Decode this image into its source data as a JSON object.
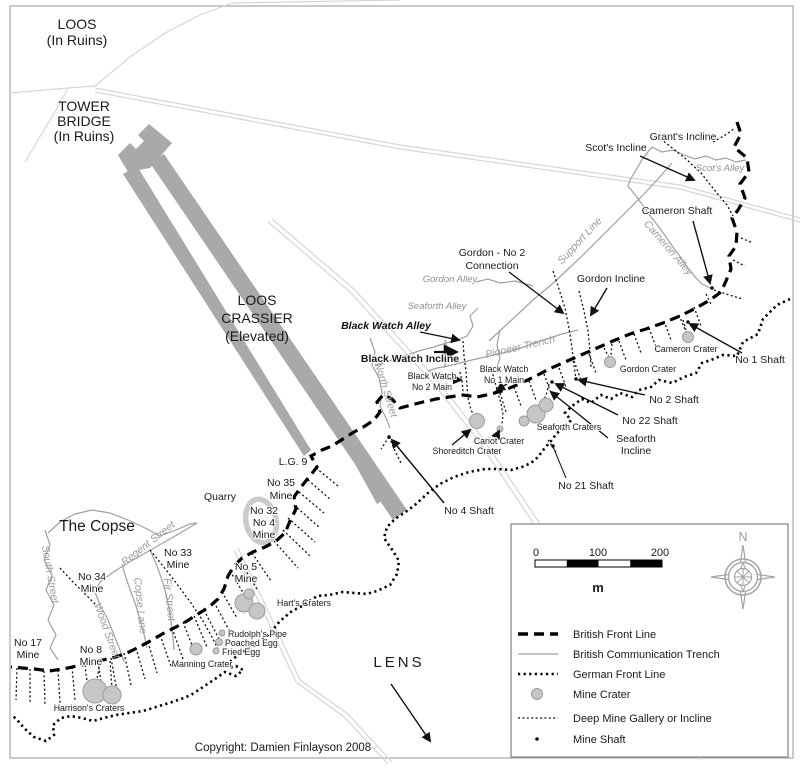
{
  "map": {
    "copyright": "Copyright: Damien Finlayson 2008",
    "colors": {
      "british_front_line": "#000000",
      "communication_trench": "#a0a0a0",
      "german_front_line": "#000000",
      "mine_gallery": "#000000",
      "crater_fill": "#c6c6c6",
      "crater_stroke": "#9c9c9c",
      "crassier_fill": "#a9a9a9",
      "road": "#d6d6d6",
      "frame": "#adadad"
    },
    "labels": [
      {
        "id": "loos",
        "lines": [
          "LOOS",
          "(In Ruins)"
        ],
        "x": 77,
        "y": 29,
        "lh": 16,
        "cls": "big"
      },
      {
        "id": "tower-bridge",
        "lines": [
          "TOWER",
          "BRIDGE",
          "(In Ruins)"
        ],
        "x": 84,
        "y": 111,
        "lh": 15,
        "cls": "big"
      },
      {
        "id": "loos-crassier",
        "lines": [
          "LOOS",
          "CRASSIER",
          "(Elevated)"
        ],
        "x": 257,
        "y": 305,
        "lh": 18,
        "cls": "big"
      },
      {
        "id": "the-copse",
        "lines": [
          "The Copse"
        ],
        "x": 97,
        "y": 531,
        "cls": "big2"
      },
      {
        "id": "lens",
        "lines": [
          "LENS"
        ],
        "x": 399,
        "y": 667,
        "cls": "lens"
      },
      {
        "id": "grants-incline",
        "lines": [
          "Grant's Incline"
        ],
        "x": 683,
        "y": 140,
        "cls": "lab"
      },
      {
        "id": "scots-incline",
        "lines": [
          "Scot's Incline"
        ],
        "x": 616,
        "y": 151,
        "cls": "lab"
      },
      {
        "id": "scots-alley",
        "lines": [
          "Scot's Alley"
        ],
        "x": 720,
        "y": 171,
        "cls": "ital"
      },
      {
        "id": "cameron-shaft",
        "lines": [
          "Cameron Shaft"
        ],
        "x": 677,
        "y": 214,
        "cls": "lab"
      },
      {
        "id": "support-line",
        "lines": [
          "Support Line"
        ],
        "x": 582,
        "y": 243,
        "rotate": -47,
        "cls": "ital2"
      },
      {
        "id": "cameron-alley",
        "lines": [
          "Cameron Alley"
        ],
        "x": 666,
        "y": 250,
        "rotate": 49,
        "cls": "ital2"
      },
      {
        "id": "gordon-no2-connection",
        "lines": [
          "Gordon - No 2",
          "Connection"
        ],
        "x": 492,
        "y": 256,
        "lh": 13,
        "cls": "lab"
      },
      {
        "id": "gordon-incline",
        "lines": [
          "Gordon Incline"
        ],
        "x": 611,
        "y": 282,
        "cls": "lab"
      },
      {
        "id": "gordon-alley",
        "lines": [
          "Gordon Alley"
        ],
        "x": 450,
        "y": 282,
        "cls": "ital"
      },
      {
        "id": "seaforth-alley",
        "lines": [
          "Seaforth Alley"
        ],
        "x": 437,
        "y": 309,
        "cls": "ital"
      },
      {
        "id": "black-watch-alley",
        "lines": [
          "Black Watch Alley"
        ],
        "x": 386,
        "y": 329,
        "cls": "boldital"
      },
      {
        "id": "pioneer-trench",
        "lines": [
          "Pioneer Trench"
        ],
        "x": 521,
        "y": 350,
        "rotate": -13,
        "cls": "ital2"
      },
      {
        "id": "black-watch-incline",
        "lines": [
          "Black Watch Incline"
        ],
        "x": 410,
        "y": 362,
        "cls": "boldlab"
      },
      {
        "id": "north-street",
        "lines": [
          "North Street"
        ],
        "x": 383,
        "y": 391,
        "rotate": 73,
        "cls": "ital2"
      },
      {
        "id": "black-watch-no2-main",
        "lines": [
          "Black Watch",
          "No 2 Main"
        ],
        "x": 432,
        "y": 379,
        "lh": 11,
        "cls": "small"
      },
      {
        "id": "black-watch-no1-main",
        "lines": [
          "Black Watch",
          "No 1 Main"
        ],
        "x": 504,
        "y": 372,
        "lh": 11,
        "cls": "small"
      },
      {
        "id": "cameron-crater",
        "lines": [
          "Cameron Crater"
        ],
        "x": 686,
        "y": 352,
        "cls": "small"
      },
      {
        "id": "no1-shaft",
        "lines": [
          "No 1 Shaft"
        ],
        "x": 760,
        "y": 363,
        "cls": "lab"
      },
      {
        "id": "gordon-crater",
        "lines": [
          "Gordon Crater"
        ],
        "x": 648,
        "y": 372,
        "cls": "small"
      },
      {
        "id": "no2-shaft",
        "lines": [
          "No 2 Shaft"
        ],
        "x": 674,
        "y": 403,
        "cls": "lab"
      },
      {
        "id": "no22-shaft",
        "lines": [
          "No 22 Shaft"
        ],
        "x": 650,
        "y": 424,
        "cls": "lab"
      },
      {
        "id": "seaforth-craters",
        "lines": [
          "Seaforth Craters"
        ],
        "x": 569,
        "y": 430,
        "cls": "small"
      },
      {
        "id": "seaforth-incline",
        "lines": [
          "Seaforth",
          "Incline"
        ],
        "x": 636,
        "y": 442,
        "lh": 12,
        "cls": "lab"
      },
      {
        "id": "cariot-crater",
        "lines": [
          "Cariot Crater"
        ],
        "x": 499,
        "y": 444,
        "cls": "small"
      },
      {
        "id": "shoreditch-crater",
        "lines": [
          "Shoreditch Crater"
        ],
        "x": 467,
        "y": 454,
        "cls": "small"
      },
      {
        "id": "no21-shaft",
        "lines": [
          "No 21 Shaft"
        ],
        "x": 586,
        "y": 489,
        "cls": "lab"
      },
      {
        "id": "no4-shaft",
        "lines": [
          "No 4 Shaft"
        ],
        "x": 469,
        "y": 514,
        "cls": "lab"
      },
      {
        "id": "lg9",
        "lines": [
          "L.G. 9"
        ],
        "x": 293,
        "y": 465,
        "cls": "lab"
      },
      {
        "id": "no35-mine",
        "lines": [
          "No 35",
          "Mine"
        ],
        "x": 281,
        "y": 486,
        "lh": 13,
        "cls": "lab"
      },
      {
        "id": "quarry",
        "lines": [
          "Quarry"
        ],
        "x": 220,
        "y": 500,
        "cls": "lab"
      },
      {
        "id": "no32-no4-mine",
        "lines": [
          "No 32",
          "No 4",
          "Mine"
        ],
        "x": 264,
        "y": 514,
        "lh": 12,
        "cls": "lab"
      },
      {
        "id": "no33-mine",
        "lines": [
          "No 33",
          "Mine"
        ],
        "x": 178,
        "y": 556,
        "lh": 12,
        "cls": "lab"
      },
      {
        "id": "no34-mine",
        "lines": [
          "No 34",
          "Mine"
        ],
        "x": 92,
        "y": 580,
        "lh": 12,
        "cls": "lab"
      },
      {
        "id": "no5-mine",
        "lines": [
          "No 5",
          "Mine"
        ],
        "x": 246,
        "y": 570,
        "lh": 12,
        "cls": "lab"
      },
      {
        "id": "regent-street",
        "lines": [
          "Regent Street"
        ],
        "x": 150,
        "y": 546,
        "rotate": -38,
        "cls": "ital2"
      },
      {
        "id": "south-street",
        "lines": [
          "South Street"
        ],
        "x": 47,
        "y": 575,
        "rotate": 80,
        "cls": "ital2"
      },
      {
        "id": "copse-lane",
        "lines": [
          "Copse Lane"
        ],
        "x": 137,
        "y": 606,
        "rotate": 84,
        "cls": "ital2"
      },
      {
        "id": "fir-street",
        "lines": [
          "Fir Street"
        ],
        "x": 166,
        "y": 600,
        "rotate": 84,
        "cls": "ital2"
      },
      {
        "id": "wood-street",
        "lines": [
          "Wood Street"
        ],
        "x": 104,
        "y": 632,
        "rotate": 70,
        "cls": "ital2"
      },
      {
        "id": "harts-craters",
        "lines": [
          "Hart's Craters"
        ],
        "x": 304,
        "y": 606,
        "cls": "small"
      },
      {
        "id": "no17-mine",
        "lines": [
          "No 17",
          "Mine"
        ],
        "x": 28,
        "y": 646,
        "lh": 12,
        "cls": "lab"
      },
      {
        "id": "no8-mine",
        "lines": [
          "No 8",
          "Mine"
        ],
        "x": 91,
        "y": 653,
        "lh": 12,
        "cls": "lab"
      },
      {
        "id": "rudolphs-pipe",
        "lines": [
          "Rudolph's Pipe"
        ],
        "x": 228,
        "y": 637,
        "cls": "small",
        "anchor": "start"
      },
      {
        "id": "poached-egg",
        "lines": [
          "Poached Egg"
        ],
        "x": 225,
        "y": 646,
        "cls": "small",
        "anchor": "start"
      },
      {
        "id": "fried-egg",
        "lines": [
          "Fried Egg"
        ],
        "x": 222,
        "y": 655,
        "cls": "small",
        "anchor": "start"
      },
      {
        "id": "manning-crater",
        "lines": [
          "Manning Crater"
        ],
        "x": 202,
        "y": 667,
        "cls": "small"
      },
      {
        "id": "harrisons-craters",
        "lines": [
          "Harrison's Craters"
        ],
        "x": 89,
        "y": 711,
        "cls": "small"
      }
    ]
  },
  "legend": {
    "compass_n": "N",
    "scale": {
      "t0": "0",
      "t100": "100",
      "t200": "200",
      "unit": "m"
    },
    "items": [
      {
        "key": "british-front-line",
        "label": "British Front Line"
      },
      {
        "key": "british-communication-trench",
        "label": "British Communication Trench"
      },
      {
        "key": "german-front-line",
        "label": "German Front Line"
      },
      {
        "key": "mine-crater",
        "label": "Mine Crater"
      },
      {
        "key": "deep-mine-gallery-or-incline",
        "label": "Deep Mine Gallery or Incline"
      },
      {
        "key": "mine-shaft",
        "label": "Mine Shaft"
      }
    ]
  }
}
